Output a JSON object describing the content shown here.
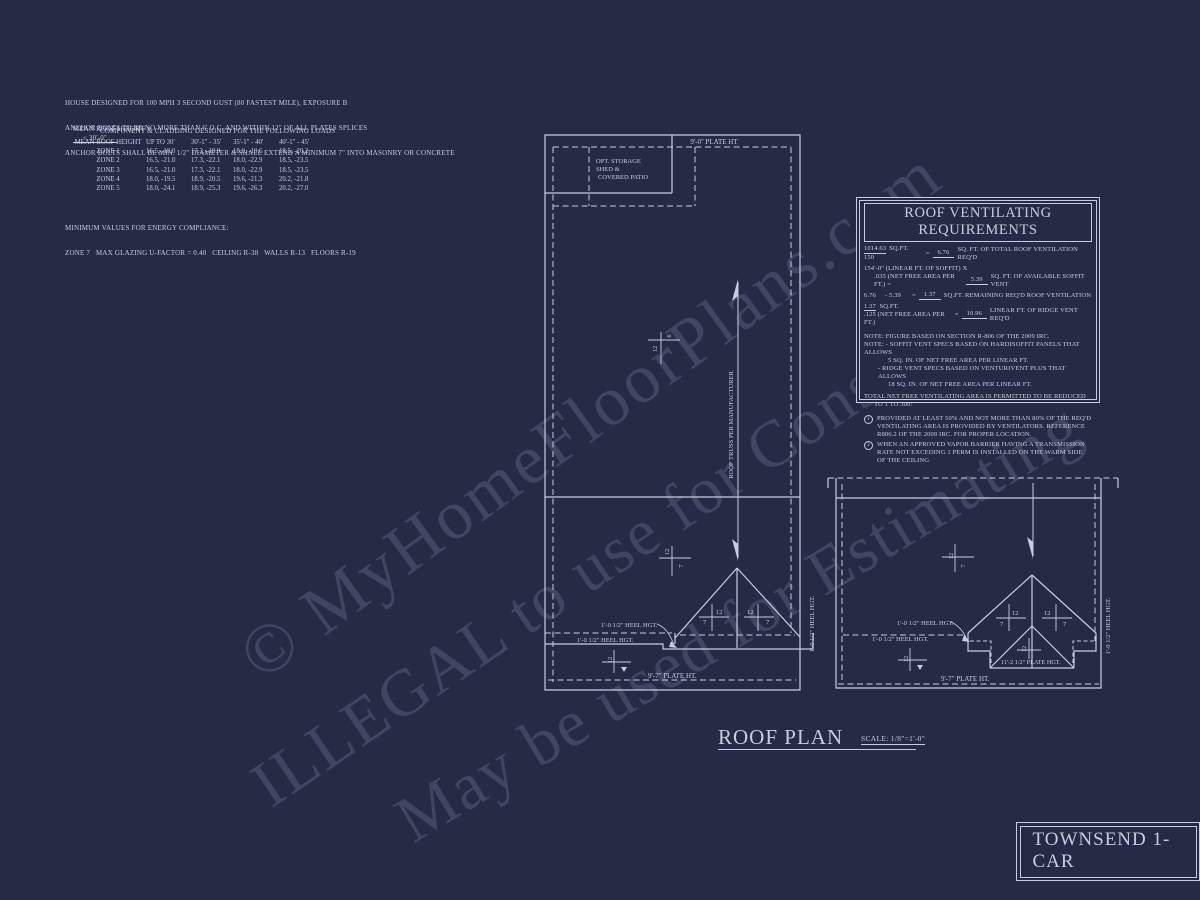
{
  "page": {
    "bg": "#262b45",
    "ink": "#c7cde0"
  },
  "notes_top": [
    "HOUSE DESIGNED FOR 100 MPH 3 SECOND GUST (80 FASTEST MILE), EXPOSURE B",
    "ANCHOR BOLTS TO BE NO MORE THAN 6' O.C. AND WITHIN 12\" OF ALL PLATES SPLICES",
    "ANCHOR BOLTS SHALL BE MIN. 1/2\" DIAMETER & SHALL EXTEND A MINIMUM 7\" INTO MASONRY OR CONCRETE"
  ],
  "mean_roof": {
    "label": "MEAN ROOF HEIGHT =",
    "value": "< 30'-0\"",
    "subtitle": "COMPONENT & CLADDING DESIGNED FOR THE FOLLOWING LOADS"
  },
  "cladding_table": {
    "headers": [
      "MEAN ROOF HEIGHT",
      "UP TO 30'",
      "30'-1\" - 35'",
      "35'-1\" - 40'",
      "40'-1\" - 45'"
    ],
    "rows": [
      [
        "ZONE 1",
        "16.5, -18.0",
        "17.3, -18.9",
        "18.0, -19.6",
        "18.5, -20.2"
      ],
      [
        "ZONE 2",
        "16.5, -21.0",
        "17.3, -22.1",
        "18.0, -22.9",
        "18.5, -23.5"
      ],
      [
        "ZONE 3",
        "16.5, -21.0",
        "17.3, -22.1",
        "18.0, -22.9",
        "18.5, -23.5"
      ],
      [
        "ZONE 4",
        "18.0, -19.5",
        "18.9, -20.5",
        "19.6, -21.3",
        "20.2, -21.8"
      ],
      [
        "ZONE 5",
        "18.0, -24.1",
        "18.9, -25.3",
        "19.6, -26.3",
        "20.2, -27.0"
      ]
    ]
  },
  "energy": [
    "MINIMUM VALUES FOR ENERGY COMPLIANCE:",
    "ZONE 7   MAX GLAZING U-FACTOR = 0.40   CEILING R-38   WALLS R-13   FLOORS R-19"
  ],
  "vent_box": {
    "title": "ROOF VENTILATING REQUIREMENTS",
    "f1": {
      "num": "1014.63",
      "num_unit": "SQ.FT.",
      "den": "150",
      "eq": "=",
      "result": "6.76",
      "desc": "SQ. FT. OF TOTAL ROOF VENTILATION REQ'D"
    },
    "f2": {
      "line1": "154'-0\" (LINEAR FT. OF SOFFIT) X",
      "line2": ".035 (NET FREE AREA PER FT.) =",
      "result": "5.39",
      "desc": "SQ. FT. OF AVAILABLE SOFFIT VENT"
    },
    "f3": {
      "a": "6.76",
      "b": "- 5.39",
      "eq": "=",
      "result": "1.37",
      "desc": "SQ.FT. REMAINING REQ'D ROOF VENTILATION"
    },
    "f4": {
      "num": "1.37",
      "num_unit": "SQ.FT.",
      "den": ".125 (NET FREE AREA PER FT.)",
      "eq": "=",
      "result": "10.96",
      "desc": "LINEAR FT. OF RIDGE VENT REQ'D"
    },
    "note1": "NOTE: FIGURE BASED ON SECTION R-806 OF THE 2009 IRC.",
    "note2a": "NOTE: - SOFFIT VENT SPECS BASED ON HARDISOFFIT PANELS THAT ALLOWS",
    "note2b": "5 SQ. IN. OF NET FREE AREA PER LINEAR FT.",
    "note2c": "- RIDGE VENT SPECS BASED ON VENTURIVENT PLUS THAT ALLOWS",
    "note2d": "18 SQ. IN. OF NET FREE AREA PER LINEAR FT.",
    "total1": "TOTAL NET FREE VENTILATING AREA IS PERMITTED TO BE REDUCED",
    "total2": "TO 1 TO 300:",
    "item1_num": "1",
    "item1a": "PROVIDED AT LEAST 50% AND NOT MORE THAN 80% OF THE REQ'D",
    "item1b": "VENTILATING AREA IS PROVIDED BY VENTILATORS.  REFERENCE",
    "item1c": "R806.2  OF THE 2009 IRC.  FOR PROPER LOCATION.",
    "item2_num": "2",
    "item2a": "WHEN AN APPROVED VAPOR BARRIER HAVING A TRANSMISSION",
    "item2b": "RATE NOT EXCEDING 1 PERM IS INSTALLED ON THE WARM SIDE",
    "item2c": "OF THE CEILING"
  },
  "plan": {
    "plate_ht_top": "9'-0\" PLATE HT",
    "opt_shed1": "OPT. STORAGE",
    "opt_shed2": "SHED &",
    "opt_shed3": "COVERED PATIO",
    "truss_note": "ROOF TRUSS PER MANUFACTURER",
    "heel_hgt": "1'-0 1/2\" HEEL HGT.",
    "plate_ht_bottom": "9'-7\" PLATE HT.",
    "plate_hgt_inner": "11'-2 1/2\" PLATE HGT.",
    "p12": "12",
    "p7": "7",
    "p6": "6"
  },
  "title": {
    "name": "ROOF PLAN",
    "scale": "SCALE: 1/8\"=1'-0\""
  },
  "sheet_title": "TOWNSEND 1-CAR",
  "watermarks": {
    "line1": "© MyHomeFloorPlans.com",
    "line2": "ILLEGAL to use for Construction",
    "line3": "May be used for Estimating"
  }
}
